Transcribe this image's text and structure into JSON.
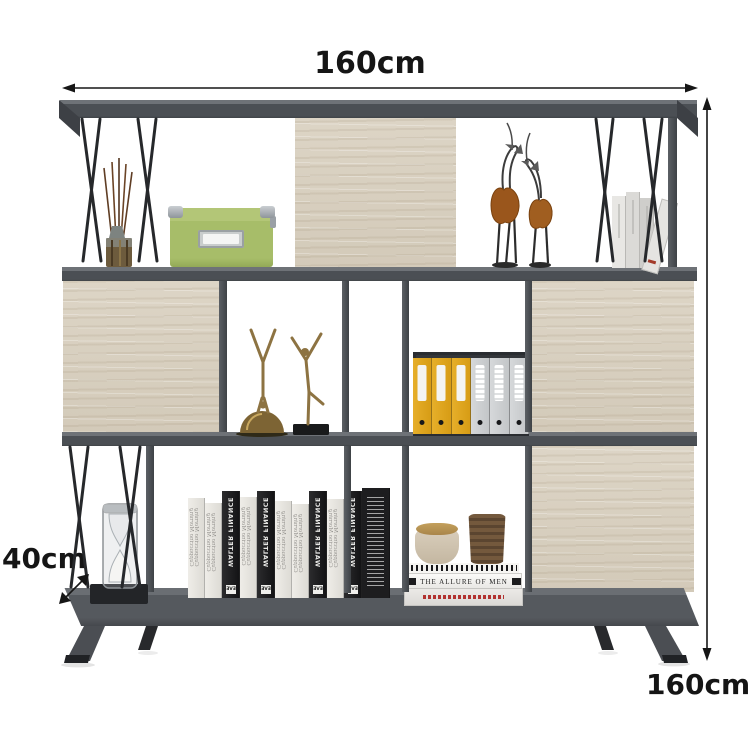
{
  "dimension_labels": {
    "width": "160cm",
    "height": "160cm",
    "depth": "40cm"
  },
  "colors": {
    "background": "#ffffff",
    "frame_gray": "#4b4f54",
    "frame_dark": "#3b3e42",
    "wood_oak": "#d9d1c2",
    "wire_black": "#26282b",
    "storage_box_green": "#a7bd69",
    "binder_yellow": "#dfa61f",
    "figurine_bronze": "#8d7342",
    "vase_brown": "#6f573d",
    "dimension_line": "#161616"
  },
  "books": {
    "black_spine_title": "WALTER FINANCE",
    "black_spine_publisher": "EVE",
    "cream_spine_script": "Cappuccino Morning",
    "stack_title": "THE ALLURE OF MEN",
    "center_spines": [
      "cream",
      "cream",
      "black",
      "cream",
      "black",
      "cream",
      "cream",
      "black",
      "cream",
      "black",
      "dense"
    ],
    "top_right_spines": [
      "cream",
      "white",
      "gray"
    ],
    "binders": [
      "yellow",
      "yellow",
      "yellow",
      "gray",
      "gray",
      "gray"
    ]
  }
}
